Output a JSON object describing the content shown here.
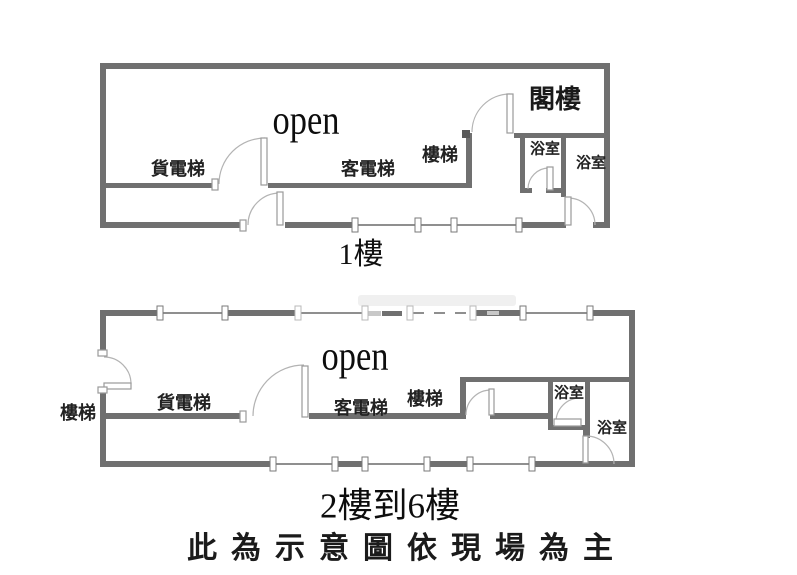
{
  "plan1": {
    "caption": "1樓",
    "open_label": "open",
    "attic": "閣樓",
    "freight_elevator": "貨電梯",
    "passenger_elevator": "客電梯",
    "stairs": "樓梯",
    "bathroom1": "浴室",
    "bathroom2": "浴室"
  },
  "plan2": {
    "caption": "2樓到6樓",
    "open_label": "open",
    "stairs_outside": "樓梯",
    "freight_elevator": "貨電梯",
    "passenger_elevator": "客電梯",
    "stairs": "樓梯",
    "bathroom1": "浴室",
    "bathroom2": "浴室"
  },
  "footer": {
    "disclaimer": "此為示意圖依現場為主"
  },
  "colors": {
    "wall": "#707070",
    "thin_wall": "#8f8f8f",
    "door_arc": "#b3b3b3",
    "text": "#1b1b1b",
    "background": "#ffffff"
  }
}
